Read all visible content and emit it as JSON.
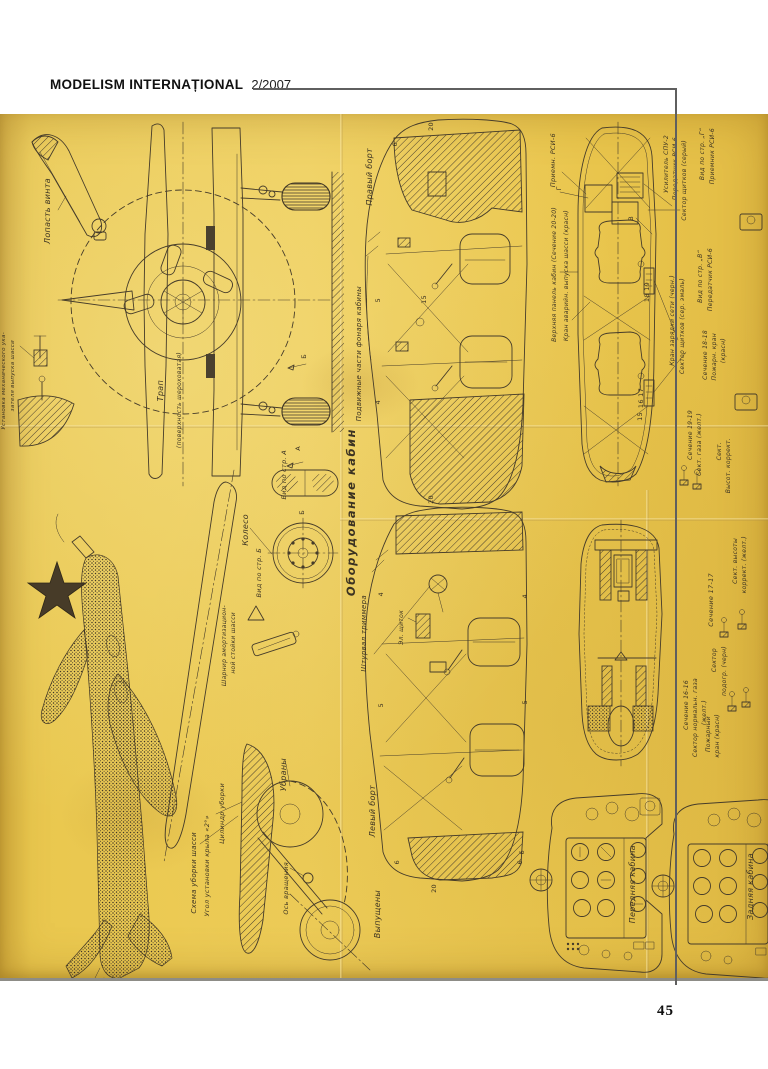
{
  "header": {
    "magazine": "MODELISM INTERNAȚIONAL",
    "issue": "2/2007"
  },
  "page_number": "45",
  "colors": {
    "paper": "#eecd58",
    "ink": "#463c2a",
    "rule": "#5f5f5f"
  },
  "plan": {
    "labels": {
      "lopast_vinta": "Лопасть винта",
      "ustanovka_1": "Установка механического ука-",
      "ustanovka_2": "зателя выпуска шасси",
      "trap": "Трап",
      "poverkhnost": "(поверхность шероховатая)",
      "pravyy_bort": "Правый борт",
      "podvizhnye": "Подвижные части фонаря кабины",
      "oborudovanie": "Оборудование кабин",
      "koleso": "Колесо",
      "vid_po_str_b": "Вид по стр. Б",
      "vid_po_str_a": "Вид по стр. А",
      "shturval": "Штурвал триммера",
      "el_shchitok": "Эл. щиток",
      "sharnir_1": "Шарнир амортизацион-",
      "sharnir_2": "ной стойки шасси",
      "os_vrashcheniya": "Ось вращения",
      "ubrany": "Убраны",
      "vypushcheny": "Выпущены",
      "levyy_bort": "Левый борт",
      "skhema_uborki": "Схема уборки шасси",
      "ugol_ustanovki": "Угол установки крыла «2°»",
      "tsilindr_uborki": "Цилиндр уборки",
      "priemn_rsi": "Приемн. РСИ-6",
      "verkhnyaya_panel": "Верхняя панель кабин (Сечение 20-20)",
      "kran_avariyn": "Кран аварийн. выпуска шасси (красн)",
      "usilitel": "Усилитель СПУ-2",
      "peredatchik": "Передатчик РСИ-6",
      "sektor_shchitkov_seryy": "Сектор щитков (серый)",
      "vid_g_1": "Вид по стр. „Г“",
      "vid_g_2": "Приемник РСИ-6",
      "vid_v_1": "Вид по стр. „В“",
      "vid_v_2": "Передатчик РСИ-6",
      "kran_zaryadki": "Кран зарядки сети (черн.)",
      "sektor_shchitkov_emal": "Сектор щитков (сер. эмаль)",
      "sechenie_18": "Сечение 18-18",
      "pozharn_18_1": "Пожарн. кран",
      "pozharn_18_2": "(красн)",
      "sechenie_19": "Сечение 19-19",
      "sekt_gaza": "Сект. газа (желт.)",
      "sekt_short": "Сект.",
      "vysot_korrekt": "Высот. коррект.",
      "sechenie_17": "Сечение 17-17",
      "sekt_vysoty_1": "Сект. высоты",
      "sekt_vysoty_2": "коррект. (желт.)",
      "sektor_podogr_1": "Сектор",
      "sektor_podogr_2": "подогр. (черн)",
      "sechenie_16": "Сечение 16-16",
      "sektor_norm_1": "Сектор нормальн. газа",
      "sektor_norm_2": "(желт.)",
      "pozharny_1": "Пожарный",
      "pozharny_2": "кран (красн)",
      "perednyaya_kabina": "Передняя кабина",
      "zadnyaya_kabina": "Задняя кабина",
      "num_20_top": "20",
      "num_6_top": "6",
      "num_15": "15",
      "num_5_top": "5",
      "num_4_top": "4",
      "num_20_mid": "20",
      "num_4_bl": "4",
      "num_4_br": "4",
      "num_5_bl": "5",
      "num_5_br": "5",
      "num_6_bl": "6",
      "num_6_br": "6",
      "num_20_bot": "20",
      "num_18_19": "18 19",
      "num_16_17": "16 17",
      "num_15_b": "15",
      "mark_g": "Г",
      "mark_v": "В",
      "mark_a": "А",
      "mark_b_wheel": "Б",
      "mark_b_front": "Б",
      "num_6_panel": "6"
    }
  }
}
